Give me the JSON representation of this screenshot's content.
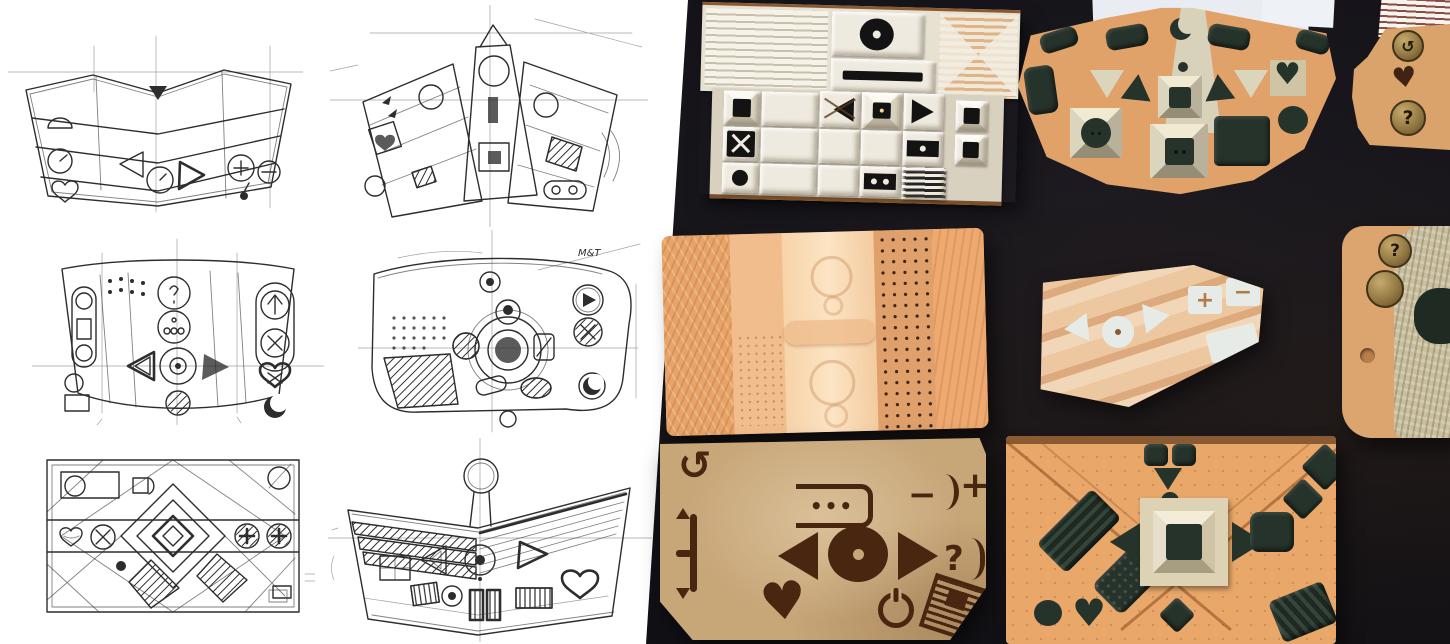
{
  "scene": {
    "left_panel": "ink concept sketches of remote controls",
    "right_panel": "photo of physical remote-control prototypes on dark table",
    "colors": {
      "paper_white": "#ffffff",
      "ink": "#2e2d2e",
      "table_dark": "#121116",
      "tile_cream": "#efeadf",
      "tile_black": "#131313",
      "cardboard_brown": "#8a5a33",
      "foam_orange": "#e8a468",
      "foam_pale": "#f7d3a8",
      "clay_green": "#26332a",
      "fan_cream": "#d9d2ba",
      "card_tan": "#c7a678",
      "etch_brown": "#48260f",
      "stripe_red": "#8a4b44",
      "paper_scrap": "#e9edf3"
    }
  },
  "glyphs": {
    "heart": "♥",
    "question": "?",
    "plus": "+",
    "minus": "−",
    "dots": "•••",
    "restart": "↺"
  },
  "sketches": [
    {
      "name": "chevron remote sketch",
      "icons": [
        "semicircle-dial",
        "clock-circle",
        "heart",
        "left-triangle",
        "center-dial",
        "right-triangle",
        "plus-circle",
        "minus-circle"
      ],
      "annotation": ""
    },
    {
      "name": "fan remote with central tower sketch",
      "icons": [
        "heart",
        "arrows",
        "circle-buttons",
        "square-frame",
        "hatched-key",
        "two-dot-pill"
      ],
      "annotation": ""
    },
    {
      "name": "curved band remote with d-pad sketch",
      "icons": [
        "pill-slider",
        "dot-grid",
        "query-circle",
        "triple-dot-circle",
        "left-triangles",
        "center-dial",
        "right-triangle",
        "up-arrow-circle",
        "x-circle",
        "heart",
        "crescent"
      ],
      "annotation": ""
    },
    {
      "name": "rounded remote with central cluster sketch",
      "icons": [
        "dot-grid",
        "hatch-region",
        "concentric-dial",
        "play-circle",
        "x-circle",
        "crescent-circle"
      ],
      "annotation": "M&T"
    },
    {
      "name": "rectangular diamond-grid remote sketch",
      "icons": [
        "corner-circle",
        "heart",
        "x-circle",
        "plus-circle",
        "minus-circle",
        "nested-diamonds"
      ],
      "annotation": ""
    },
    {
      "name": "chevron striped remote sketch",
      "icons": [
        "top-circle",
        "striped-bands",
        "left-triangle",
        "center-dial",
        "right-triangle",
        "striped-keys",
        "heart"
      ],
      "annotation": ""
    }
  ],
  "prototypes": [
    {
      "name": "white tile remote",
      "material": "white card tiles on cardboard",
      "buttons": [
        "ridged-grip",
        "record-circle",
        "black-bar",
        "striped-bowtie",
        "black-square",
        "triangle-x-key",
        "pyramid-key",
        "right-triangle-key",
        "x-square",
        "dot-bar",
        "circle-key",
        "two-dot-bar",
        "barcode-key"
      ]
    },
    {
      "name": "fan remote",
      "material": "orange foam with green clay keys",
      "buttons": [
        "crescent-cutout",
        "tower-frame",
        "cream-triangles",
        "green-triangles",
        "circle-two-dot-frame",
        "square-two-dot-frame",
        "green-square",
        "heart-key",
        "circle-key",
        "green-pills"
      ]
    },
    {
      "name": "edge remote top",
      "material": "tan clay with ridged paper",
      "buttons": [
        "ridged-grip",
        "restart-coin",
        "heart-cutout",
        "question-coin"
      ]
    },
    {
      "name": "edge remote middle",
      "material": "tan clay with crackle glaze",
      "buttons": [
        "question-coin",
        "blank-coin",
        "small-dot",
        "dark-blob"
      ]
    },
    {
      "name": "textured foam slab",
      "material": "orange foam, embossed and perforated bands",
      "buttons": [
        "embossed-circles",
        "perforated-dot-band",
        "ridge-bar"
      ]
    },
    {
      "name": "cardboard wedge remote",
      "material": "plywood-tone cardboard with white keys",
      "buttons": [
        "left-triangle",
        "dot-circle",
        "right-triangle",
        "plus-key",
        "minus-key",
        "blank-key"
      ]
    },
    {
      "name": "laser-etched cardboard remote",
      "material": "etched cardboard",
      "buttons": [
        "restart",
        "volume-slider",
        "dots-pill",
        "left-triangle",
        "record-dial",
        "right-triangle",
        "minus-arc",
        "plus-arc",
        "question-arc",
        "heart",
        "power",
        "hatch-pad"
      ]
    },
    {
      "name": "foam V remote",
      "material": "orange foam with green clay keys",
      "buttons": [
        "top-cluster",
        "striped-pad",
        "dotted-pad",
        "left-triangle",
        "pyramid-frame",
        "right-triangle",
        "rounded-square",
        "diamond",
        "corner-pad",
        "circle",
        "heart",
        "bottom-diamond",
        "striped-corner-pad"
      ]
    }
  ]
}
